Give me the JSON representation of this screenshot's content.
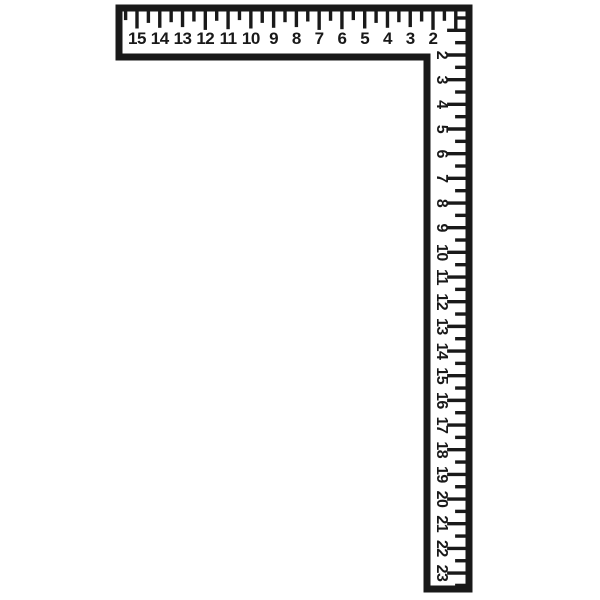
{
  "illustration": {
    "subject": "carpenter-framing-square",
    "description": "L-shaped framing square ruler line drawing",
    "background_color": "#ffffff",
    "ink_color": "#191919"
  },
  "horizontal_ruler": {
    "orientation": "horizontal",
    "edge": "top",
    "numbers": [
      15,
      14,
      13,
      12,
      11,
      10,
      9,
      8,
      7,
      6,
      5,
      4,
      3,
      2
    ],
    "ticks_per_unit": 2
  },
  "vertical_ruler": {
    "orientation": "vertical",
    "edge": "right",
    "numbers": [
      2,
      3,
      4,
      5,
      6,
      7,
      8,
      9,
      10,
      11,
      12,
      13,
      14,
      15,
      16,
      17,
      18,
      19,
      20,
      21,
      22,
      23
    ],
    "ticks_per_unit": 2,
    "label_rotation_deg": 90
  }
}
